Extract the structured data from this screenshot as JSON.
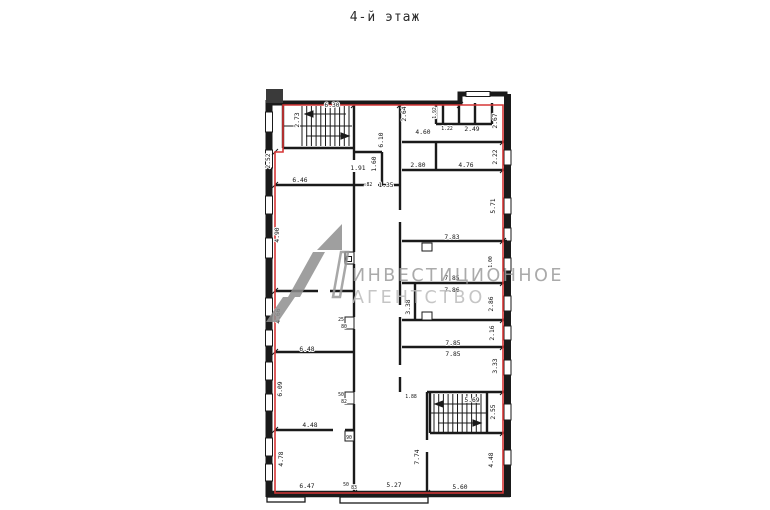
{
  "title": "4-й этаж",
  "watermark": {
    "line1": "ИНВЕСТИЦИОННОЕ",
    "line2": "АГЕНТСТВО"
  },
  "colors": {
    "boundary_red": "#d63636",
    "wall": "#1a1a1a",
    "watermark_grey": "#9c9c9c"
  },
  "dims": {
    "d630": "6.30",
    "d273": "2.73",
    "d252": "2.52",
    "d610": "6.10",
    "d191": "1.91",
    "d160": "1.60",
    "d082": ".82",
    "d135": "1.35",
    "d646": "6.46",
    "d264": "2.64",
    "d460": "4.60",
    "d192": "1.92",
    "d122": "1.22",
    "d249": "2.49",
    "d267": "2.67",
    "d222": "2.22",
    "d280": "2.80",
    "d476": "4.76",
    "d571": "5.71",
    "d783": "7.83",
    "d100": "1.00",
    "d785a": "7.85",
    "d786": "7.86",
    "d286": "2.86",
    "d338": "3.38",
    "d216": "2.16",
    "d785b": "7.85",
    "d785c": "7.85",
    "d333": "3.33",
    "d569": "5.69",
    "d255": "2.55",
    "d448v": "4.48",
    "d560": "5.60",
    "d774": "7.74",
    "d527": "5.27",
    "d188": "1.88",
    "d490": "4.90",
    "d466": "4.66",
    "d648": "6.48",
    "d609": "6.09",
    "d448": "4.48",
    "d90": "90",
    "d478": "4.78",
    "d647": "6.47",
    "d50b": "50",
    "d83": "83",
    "d25": "25",
    "d80": "80",
    "d50": "50",
    "d82": "82"
  }
}
